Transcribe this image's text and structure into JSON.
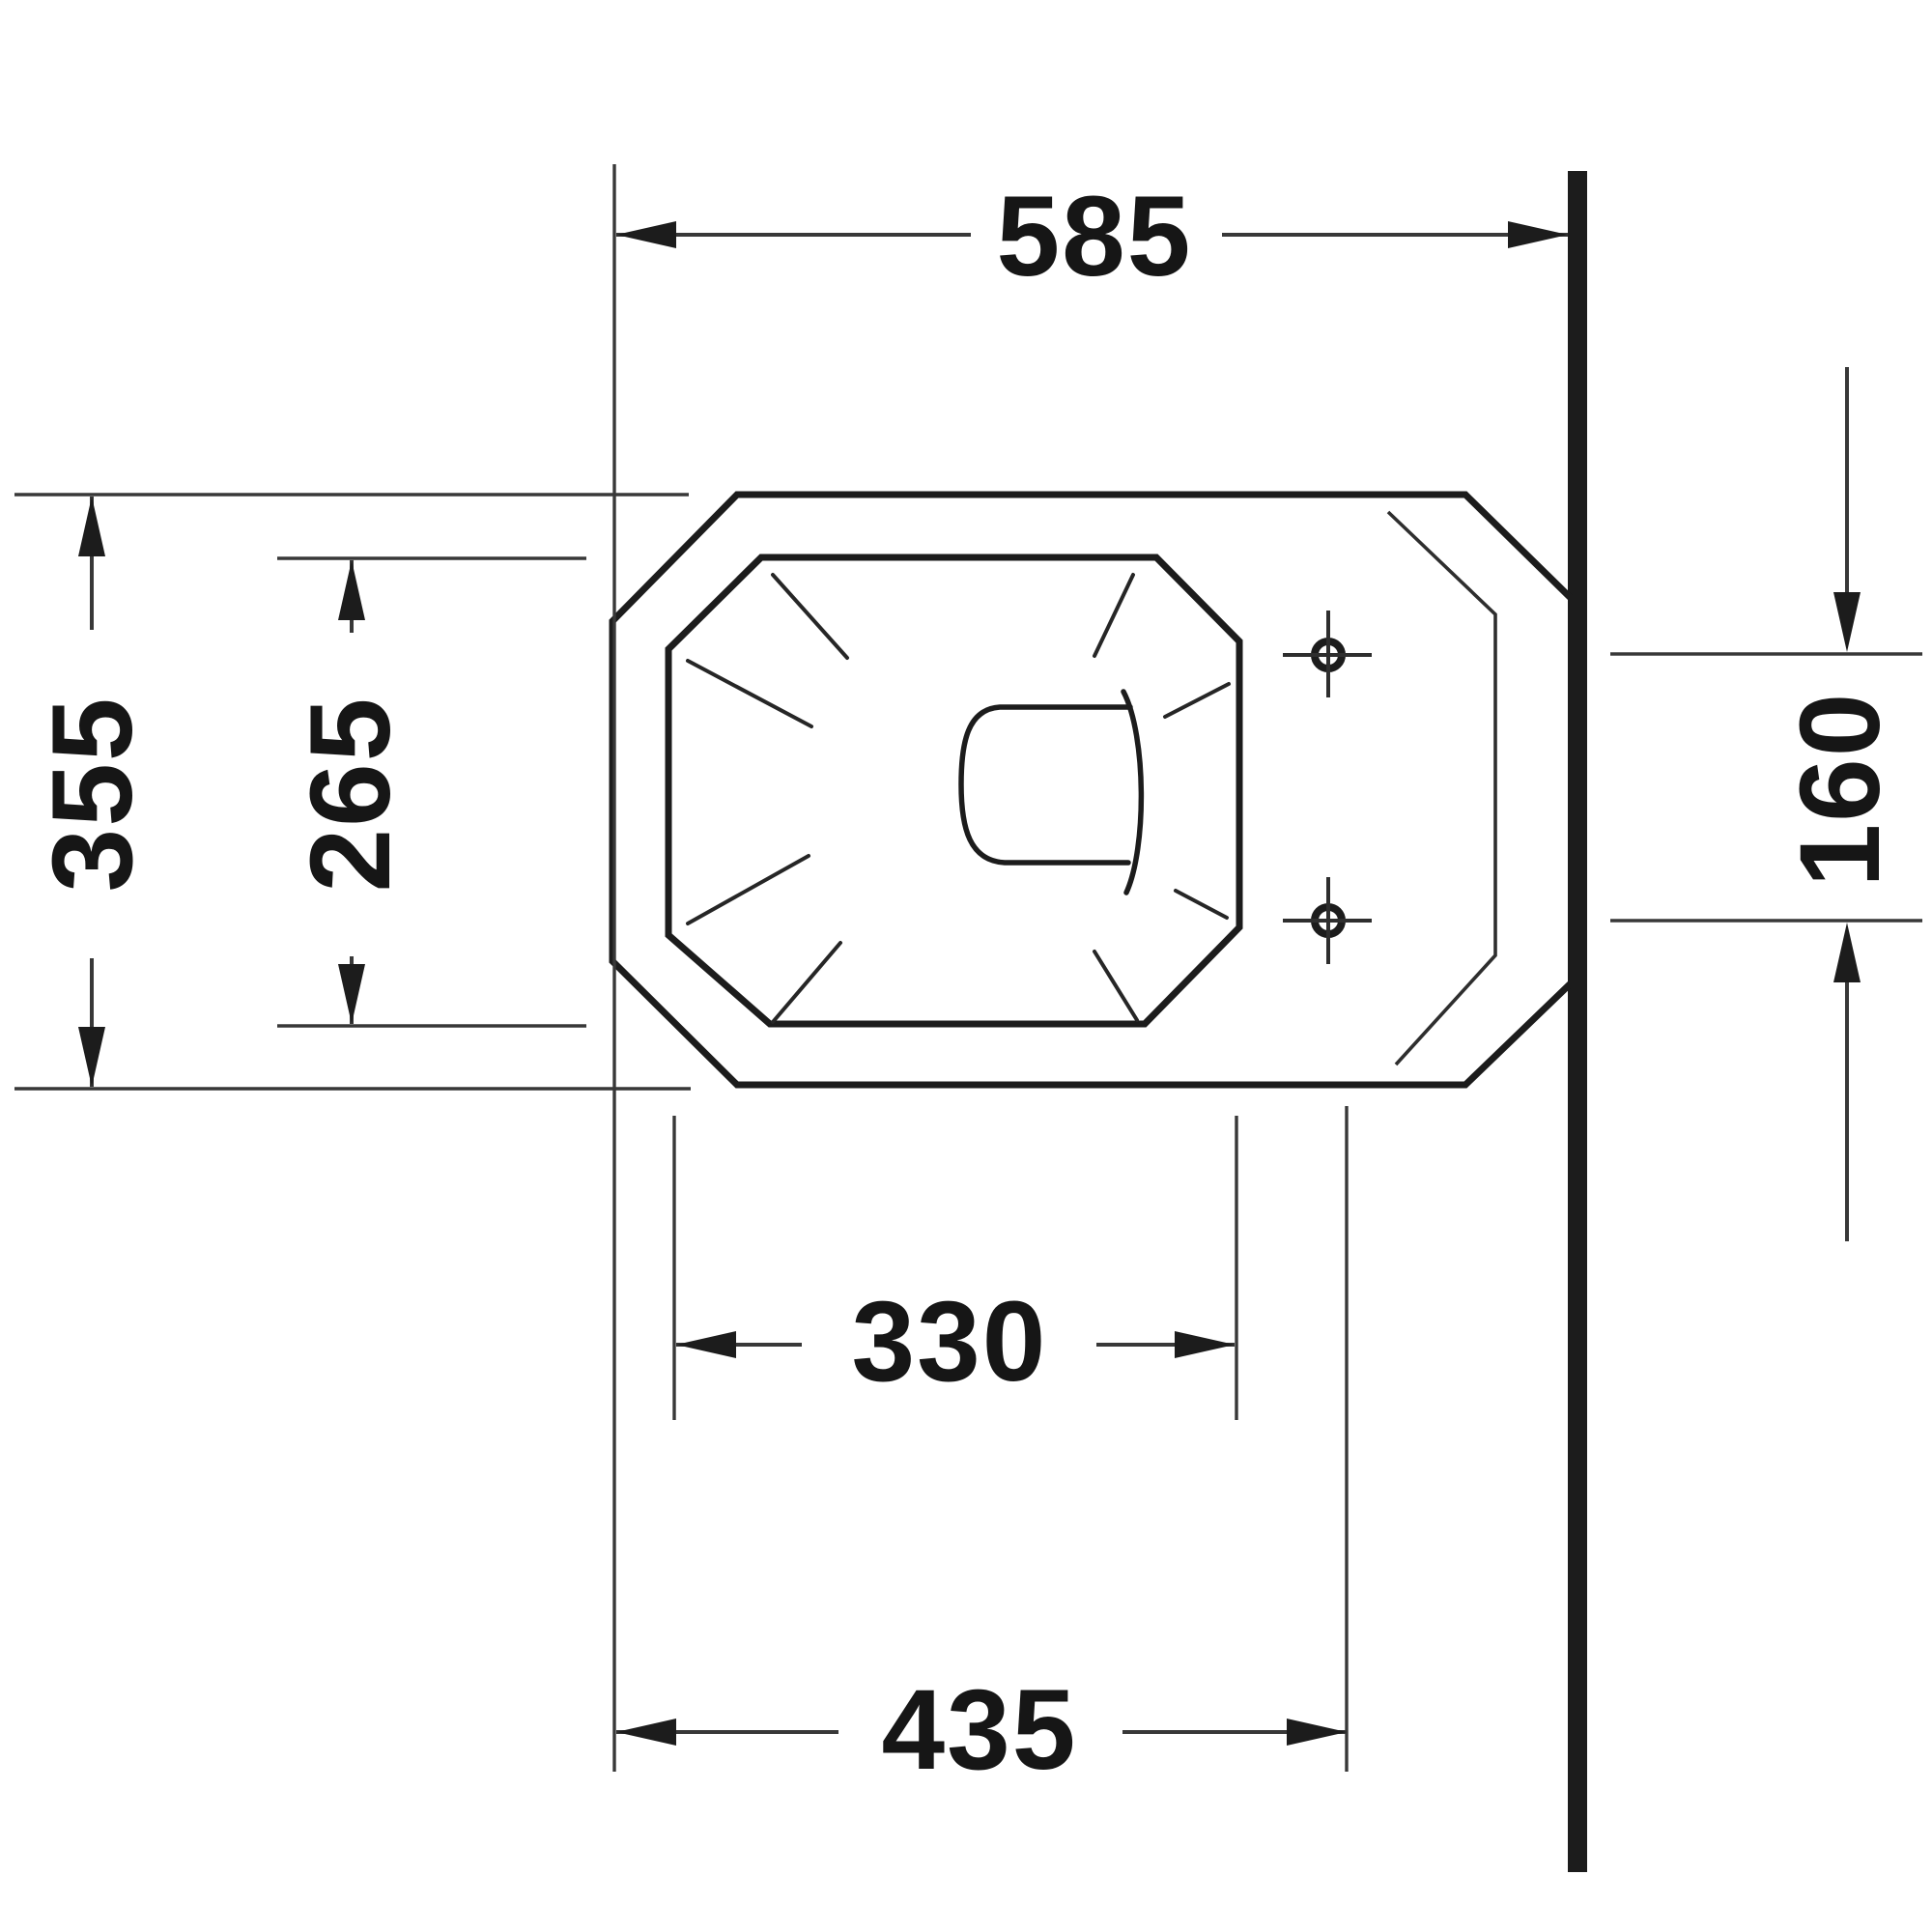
{
  "drawing": {
    "title": "toilet-plan-view-technical-drawing",
    "units": "mm",
    "background_color": "#ffffff",
    "line_color": "#1c1c1c",
    "thin_line_color": "#2e2e2e",
    "wall_color": "#161616",
    "dimensions": {
      "overall_width": "585",
      "overall_depth": "355",
      "bowl_inner_depth": "265",
      "fixing_hole_spacing": "160",
      "bowl_inner_width": "330",
      "front_edge_to_outlet": "435"
    }
  },
  "chart_data": {
    "type": "table",
    "title": "Dimension callouts (mm)",
    "categories": [
      "overall width",
      "overall depth",
      "bowl inner depth",
      "fixing hole spacing",
      "bowl inner width",
      "front edge to outlet line"
    ],
    "values": [
      585,
      355,
      265,
      160,
      330,
      435
    ]
  }
}
